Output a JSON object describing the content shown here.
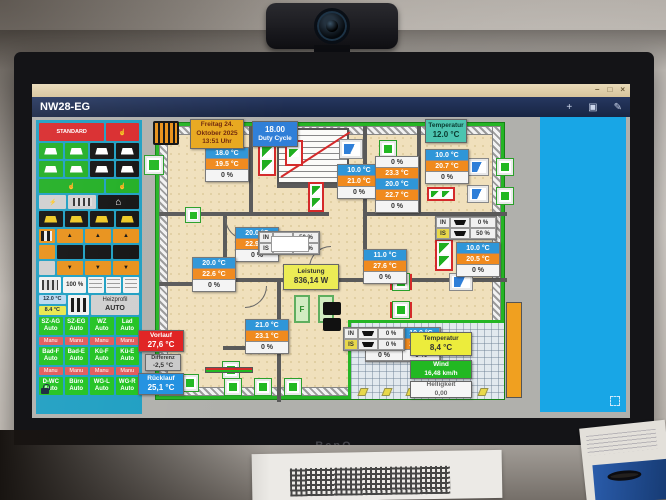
{
  "scene": {
    "monitor_brand": "BenQ"
  },
  "titlebar": {
    "minimize": "–",
    "maximize": "□",
    "close": "×"
  },
  "appbar": {
    "title": "NW28-EG",
    "add_icon": "+",
    "save_icon": "▣",
    "edit_icon": "✎"
  },
  "glyphs": {
    "hand": "☝",
    "bolt": "⚡",
    "house": "⌂",
    "chev_up": "▲",
    "chev_down": "▼"
  },
  "infobar": {
    "date": {
      "line1": "Freitag 24.",
      "line2": "Oktober 2025",
      "line3": "13:51 Uhr"
    },
    "duty": {
      "value": "18.00",
      "label": "Duty Cycle"
    },
    "outdoor": {
      "label": "Temperatur",
      "value": "12.0 °C"
    }
  },
  "sidebar": {
    "standard": "STANDARD",
    "percent": "100 %",
    "temp_out": "12.0 °C",
    "temp_yellow": "8.4 °C",
    "heiz_label": "Heizprofil",
    "heiz_value": "AUTO",
    "auto": "Auto",
    "manu": "Manu",
    "zones_row1": [
      "SZ-AG",
      "SZ-EG",
      "WZ",
      "Lad"
    ],
    "zones_row2": [
      "Bad-F",
      "Bad-E",
      "Kü-F",
      "Kü-E"
    ],
    "zones_row3": [
      "D-WC",
      "Büro",
      "WG-L",
      "WG-R"
    ]
  },
  "plan": {
    "rooms": [
      {
        "set": "18.0 °C",
        "act": "19.5 °C",
        "valve": "0 %"
      },
      {
        "set": "20.0 °C",
        "act": "22.9 °C",
        "valve": "0 %"
      },
      {
        "set": "20.0 °C",
        "act": "22.6 °C",
        "valve": "0 %"
      },
      {
        "set": "10.0 °C",
        "act": "21.0 °C",
        "valve": "0 %"
      },
      {
        "set": "10.0 °C",
        "act": "20.7 °C",
        "valve": "0 %"
      },
      {
        "set": "10.0 °C",
        "act": "20.5 °C",
        "valve": "0 %"
      },
      {
        "set": "11.0 °C",
        "act": "27.6 °C",
        "valve": "0 %"
      },
      {
        "set": "21.0 °C",
        "act": "23.1 °C",
        "valve": "0 %"
      }
    ],
    "stack": [
      "0 %",
      "23.3 °C",
      "20.0 °C",
      "22.7 °C",
      "0 %"
    ],
    "pair": {
      "set1": "10.0 °C",
      "set2": "10.0 °C",
      "act1": "26.0 °C",
      "act2": "28.9 °C",
      "v1": "0 %",
      "v2": "0 %"
    },
    "shutters": [
      {
        "in_label": "IN",
        "in_val": "50 %",
        "is_label": "IS",
        "is_val": "50 %"
      },
      {
        "in_label": "IN",
        "in_val": "0 %",
        "is_label": "IS",
        "is_val": "50 %"
      },
      {
        "in_label": "IN",
        "in_val": "0 %",
        "is_label": "IS",
        "is_val": "0 %"
      }
    ],
    "leistung": {
      "label": "Leistung",
      "value": "836,14 W"
    },
    "vorlauf": {
      "label": "Vorlauf",
      "value": "27,6 °C"
    },
    "differenz": {
      "label": "Differenz",
      "value": "-2,5 °C"
    },
    "ruecklauf": {
      "label": "Rücklauf",
      "value": "25,1 °C"
    },
    "weather": {
      "temp_label": "Temperatur",
      "temp_value": "8,4 °C",
      "wind_label": "Wind",
      "wind_value": "16,48 km/h",
      "bright_label": "Helligkeit",
      "bright_value": "0,00"
    }
  }
}
